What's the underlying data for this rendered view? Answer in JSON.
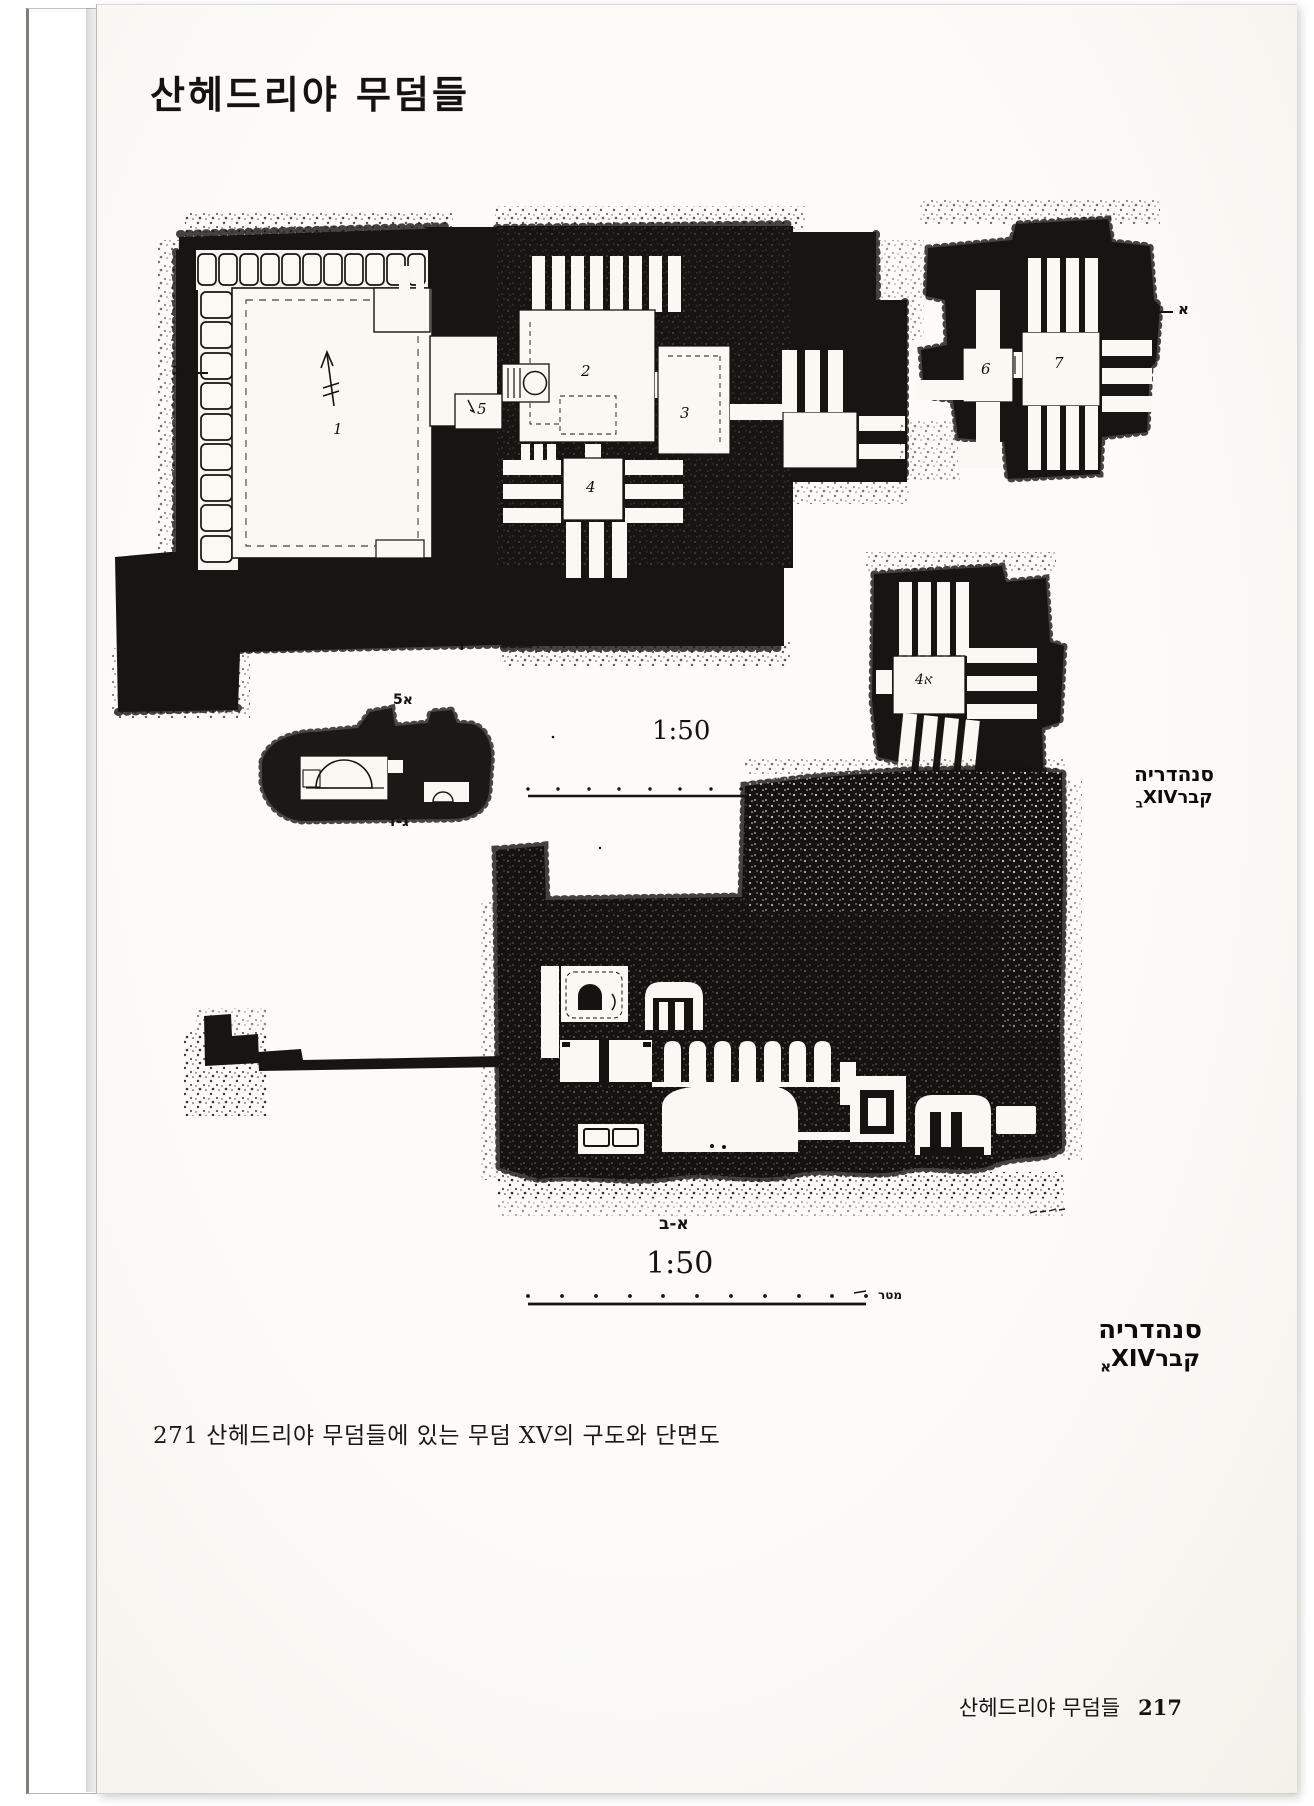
{
  "page": {
    "title": "산헤드리야 무덤들",
    "caption": "271 산헤드리야 무덤들에 있는 무덤 XV의 구도와 단면도",
    "footer_section": "산헤드리야 무덤들",
    "footer_page": "217"
  },
  "plan_figure": {
    "rooms": {
      "r1": "1",
      "r2": "2",
      "r3": "3",
      "r4": "4",
      "r5": "5",
      "r6": "6",
      "r7": "7",
      "annex": "4א"
    },
    "markers": {
      "left": "ב",
      "bottom": "ד",
      "right": "א"
    },
    "mini_section": {
      "top": "5א",
      "bottom": "ג-ד"
    },
    "scale_ratio": "1:50",
    "scale_unit": "מטר",
    "hebrew_caption": {
      "line1": "סנהדריה",
      "line2": "קברXIV",
      "line2_sub": "ב"
    }
  },
  "section_figure": {
    "cut_label": "א-ב",
    "scale_ratio": "1:50",
    "scale_unit": "מטר",
    "hebrew_caption": {
      "line1": "סנהדריה",
      "line2": "קברXIV",
      "line2_sub": "א"
    }
  }
}
